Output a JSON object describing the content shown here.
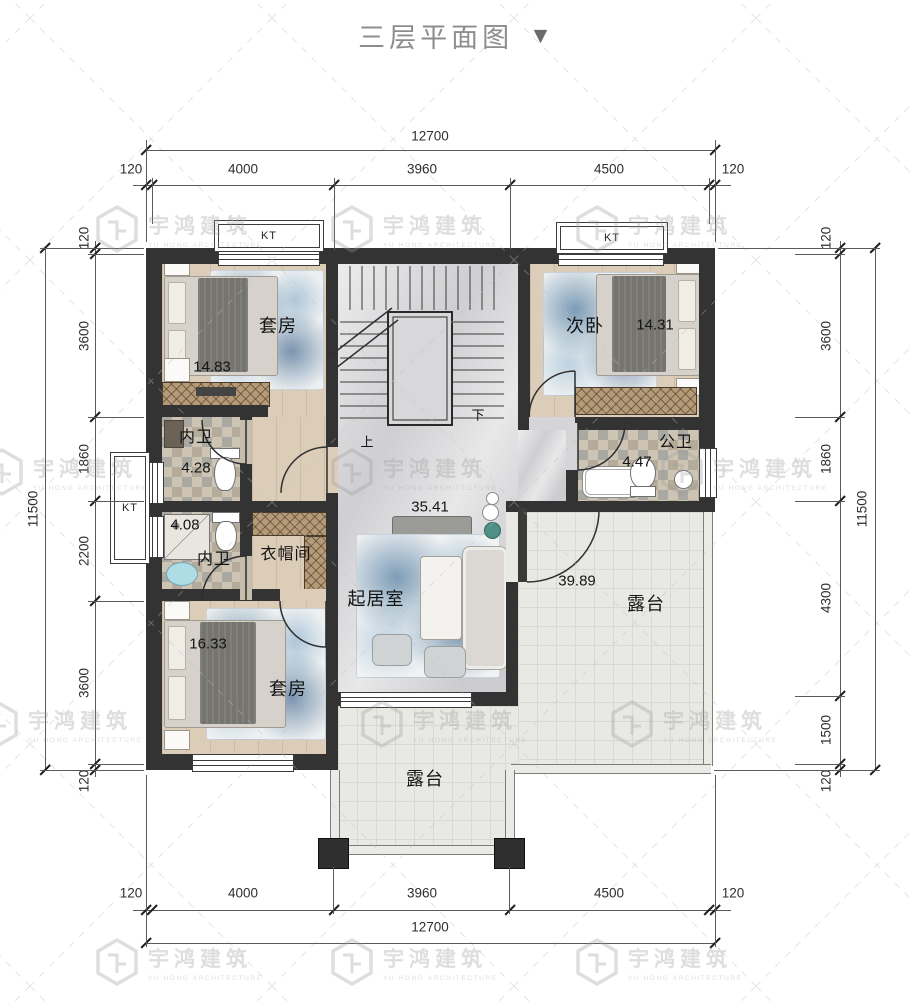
{
  "title": {
    "text": "三层平面图"
  },
  "watermark": {
    "brand": "宇鸿建筑",
    "sub": "YU HONG ARCHITECTURE"
  },
  "dims": {
    "top_overall": "12700",
    "top_segments": [
      "120",
      "4000",
      "3960",
      "4500",
      "120"
    ],
    "bottom_overall": "12700",
    "bottom_segments": [
      "120",
      "4000",
      "3960",
      "4500",
      "120"
    ],
    "left_overall": "11500",
    "left_segments": [
      "120",
      "3600",
      "1860",
      "2200",
      "3600",
      "120"
    ],
    "right_overall": "11500",
    "right_segments": [
      "120",
      "3600",
      "1860",
      "4300",
      "1500",
      "120"
    ]
  },
  "rooms": {
    "suite_top": {
      "name": "套房",
      "area": "14.83"
    },
    "bedroom_second": {
      "name": "次卧",
      "area": "14.31"
    },
    "bath_inner_top": {
      "name": "内卫",
      "area": "4.28"
    },
    "bath_public": {
      "name": "公卫",
      "area": "4.47"
    },
    "bath_inner_low": {
      "name": "内卫",
      "area": "4.08"
    },
    "cloakroom": {
      "name": "衣帽间"
    },
    "living": {
      "name": "起居室",
      "area": "35.41"
    },
    "terrace_right": {
      "name": "露台",
      "area": "39.89"
    },
    "suite_bottom": {
      "name": "套房",
      "area": "16.33"
    },
    "terrace_bottom": {
      "name": "露台"
    }
  },
  "stairs": {
    "up": "上",
    "down": "下"
  },
  "ac": {
    "label": "KT"
  }
}
